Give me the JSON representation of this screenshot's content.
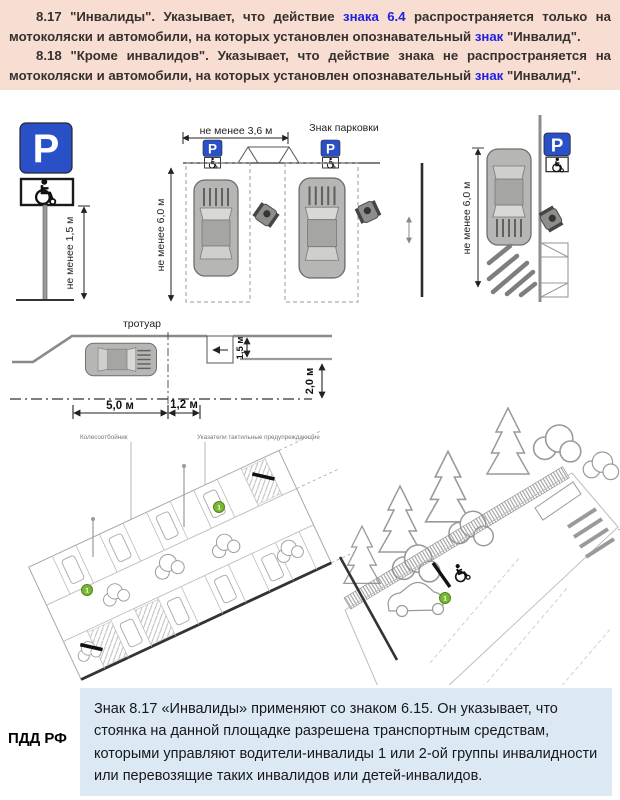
{
  "colors": {
    "header-bg": "#f8ddd2",
    "link-blue": "#2020e0",
    "box-bg": "#dce9f5",
    "sign-blue": "#2a50c8",
    "marker-green": "#76b82e"
  },
  "intro": {
    "p1": {
      "s1": "8.17 \"Инвалиды\". Указывает, что действие ",
      "s2": "знака 6.4",
      "s3": " распространяется только на мотоколяски и автомобили, на которых установлен опознавательный ",
      "s4": "знак",
      "s5": " \"Инвалид\"."
    },
    "p2": {
      "s1": "8.18 \"Кроме инвалидов\". Указывает, что действие знака не распространяется на мотоколяски и автомобили, на которых установлен опознавательный ",
      "s2": "знак",
      "s3": " \"Инвалид\"."
    }
  },
  "diagram": {
    "p_letter": "P",
    "sign_post": {
      "min_height": "не менее 1,5 м"
    },
    "perpendicular": {
      "width_dim": "не менее 3,6 м",
      "parking_sign_label": "Знак парковки",
      "depth_dim": "не менее 6,0 м"
    },
    "parallel": {
      "length_dim": "не менее 6,0 м"
    },
    "street": {
      "sidewalk_label": "тротуар",
      "dim_5m": "5,0 м",
      "dim_1_2m": "1,2 м",
      "dim_1_5m": "1,5 м",
      "dim_2m": "2,0 м"
    },
    "iso_left": {
      "label_wheel_stop": "Колесоотбойник",
      "label_tactile": "Указатели тактильные предупреждающие",
      "marker1": "1",
      "marker2": "1"
    },
    "iso_right": {
      "marker": "1"
    }
  },
  "footer": {
    "source_label": "ПДД РФ",
    "note": "Знак 8.17 «Инвалиды» применяют со знаком 6.15. Он указывает, что стоянка на данной площадке разрешена транспортным средствам, которыми управляют водители-инвалиды 1 или 2-ой группы инвалидности или перевозящие таких инвалидов или детей-инвалидов."
  }
}
